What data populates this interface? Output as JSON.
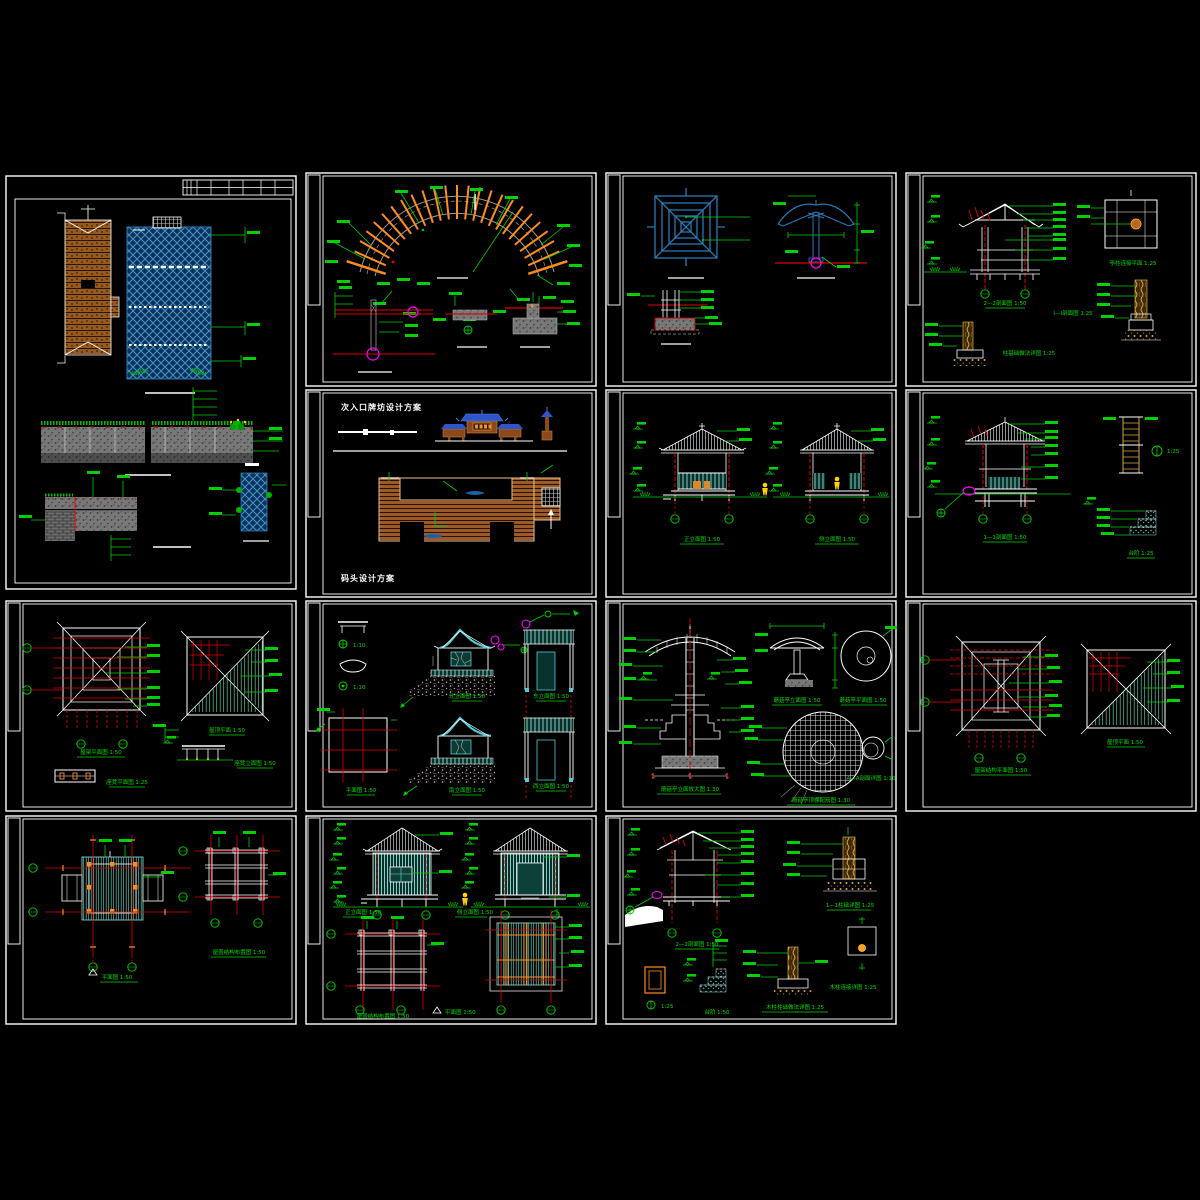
{
  "app": {
    "background": "#000000",
    "description": "CAD drawing set - landscape structure details"
  },
  "palette": {
    "frame_white": "#ffffff",
    "annotation_green": "#00df00",
    "dimension_red": "#e00000",
    "water_blue": "#2878b4",
    "deep_blue": "#1f5fa8",
    "roof_blue": "#2f55cc",
    "arch_orange": "#ff8c1e",
    "wood_brown": "#9c5a28",
    "wood_yellow": "#d9a441",
    "wall_teal": "#7fd2c8",
    "stone_gray": "#787878",
    "highlight_magenta": "#ff00ff",
    "figure_yellow": "#ffd400"
  },
  "sheets": [
    {
      "id": "waterfront-plan-details",
      "cap": []
    },
    {
      "id": "arch-pergola-details",
      "cap": []
    },
    {
      "id": "umbrella-pavilion-details",
      "cap": []
    },
    {
      "id": "pavilion-section-details",
      "cap": [
        "2—2剖面图 1:50",
        "亭柱连接平面 1:25",
        "Ⅰ—Ⅰ剖面图 1:25",
        "柱基础做法详图 1:25"
      ]
    },
    {
      "id": "entrance-dock-schemes",
      "cap": [
        "次入口牌坊设计方案",
        "码头设计方案"
      ]
    },
    {
      "id": "gazebo-elevations",
      "cap": [
        "正立面图 1:50",
        "侧立面图 1:50"
      ]
    },
    {
      "id": "gazebo-section-details",
      "cap": [
        "1—1剖面图 1:50",
        "1:25",
        "台阶 1:25"
      ]
    },
    {
      "id": "roof-framing-bench-details",
      "cap": [
        "屋架平面图 1:50",
        "屋顶平面 1:50",
        "座凳立面图 1:50",
        "座凳平面图 1:25"
      ]
    },
    {
      "id": "gatehouse-elevations",
      "cap": [
        "1:10",
        "1:10",
        "北立面图 1:50",
        "东立面图 1:50",
        "南立面图 1:50",
        "西立面图 1:50",
        "平面图 1:50"
      ]
    },
    {
      "id": "mushroom-pavilion-details",
      "cap": [
        "蘑菇亭立面放大图 1:30",
        "蘑菇亭立面图 1:50",
        "蘑菇亭平面图 1:50",
        "蘑菇亭顶棚配筋图 1:30",
        "A—A剖面详图 1:10"
      ]
    },
    {
      "id": "roof-structure-plans",
      "cap": [
        "屋架结构平面图 1:50",
        "屋顶平面 1:50"
      ]
    },
    {
      "id": "pavilion-plan-structure",
      "cap": [
        "平面图 1:50",
        "屋盖结构布置图 1:50"
      ]
    },
    {
      "id": "hut-elevations-plans",
      "cap": [
        "正立面图 1:50",
        "侧立面图 1:50",
        "屋盖结构布置图 1:50",
        "平面图 1:50"
      ]
    },
    {
      "id": "hut-section-details",
      "cap": [
        "2—2剖面图 1:50",
        "1—1柱础详图 1:25",
        "木柱柱础做法详图 1:25",
        "1:25",
        "台阶 1:50",
        "木柱连接详图 1:25"
      ]
    }
  ]
}
